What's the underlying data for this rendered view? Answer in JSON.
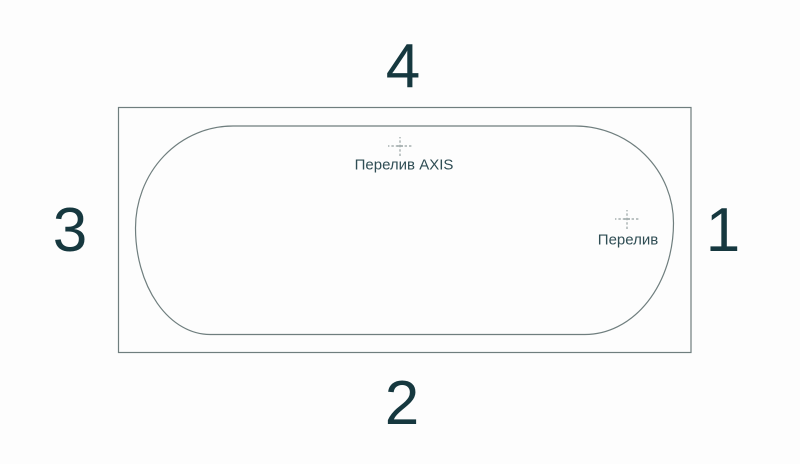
{
  "diagram": {
    "name": "bathtub-top-view-scheme",
    "side_labels": {
      "top": "4",
      "bottom": "2",
      "left": "3",
      "right": "1"
    },
    "markers": {
      "overflow_axis": {
        "label": "Перелив AXIS"
      },
      "overflow": {
        "label": "Перелив"
      }
    }
  },
  "colors": {
    "bg": "#fdfdfd",
    "line": "#6f7e7e",
    "marker": "#a6b0b0",
    "text": "#16383f",
    "label": "#2f4d54"
  }
}
